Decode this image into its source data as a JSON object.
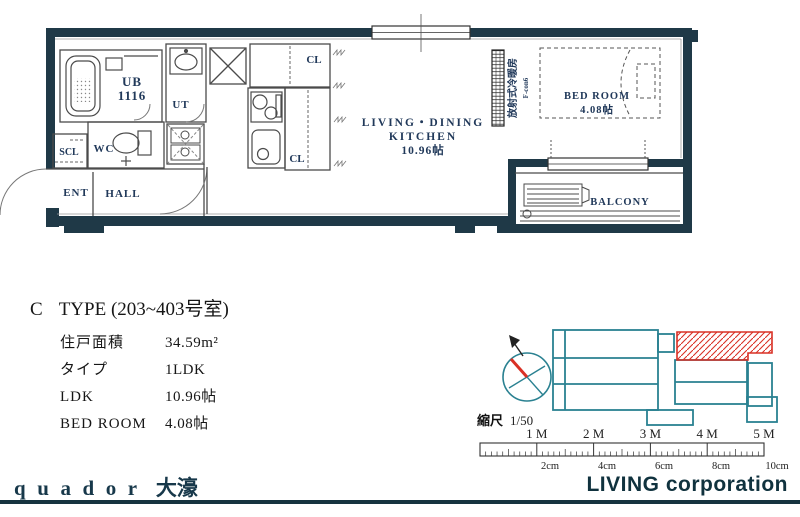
{
  "plan": {
    "rooms": {
      "ub_line1": "UB",
      "ub_line2": "1116",
      "ut": "UT",
      "scl": "SCL",
      "wc": "WC",
      "ent": "ENT",
      "hall": "HALL",
      "cl_upper": "CL",
      "cl_lower": "CL",
      "ldk_line1": "LIVING・DINING",
      "ldk_line2": "KITCHEN",
      "ldk_line3": "10.96帖",
      "bedroom_line1": "BED ROOM",
      "bedroom_line2": "4.08帖",
      "balcony": "BALCONY",
      "heater_line1": "放射式冷暖房",
      "heater_line2": "F-con6"
    }
  },
  "info": {
    "type_letter": "C",
    "type_title": "TYPE (203~403号室)",
    "rows": [
      {
        "label": "住戸面積",
        "value": "34.59m²"
      },
      {
        "label": "タイプ",
        "value": "1LDK"
      },
      {
        "label": "LDK",
        "value": "10.96帖"
      },
      {
        "label": "BED ROOM",
        "value": "4.08帖"
      }
    ]
  },
  "location": {
    "scale_label": "縮尺",
    "scale_value": "1/50",
    "ruler_m": [
      "1 M",
      "2 M",
      "3 M",
      "4 M",
      "5 M"
    ],
    "ruler_cm": [
      "2cm",
      "4cm",
      "6cm",
      "8cm",
      "10cm"
    ]
  },
  "footer": {
    "brand": "quador",
    "brand_suffix": "大濠",
    "company": "LIVING corporation"
  },
  "colors": {
    "wall": "#1f3947",
    "site_teal": "#2a8191",
    "highlight_red": "#d93025",
    "label_navy": "#21395a"
  }
}
